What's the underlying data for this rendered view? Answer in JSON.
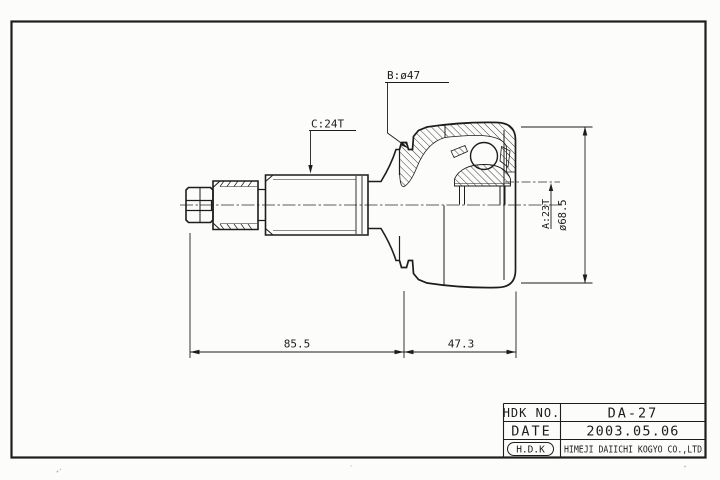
{
  "sheet": {
    "background": "#fcfcfa",
    "line_color": "#1d1d1d"
  },
  "callouts": {
    "b": "B:ø47",
    "c": "C:24T",
    "a": "A:23T",
    "housing_dia": "ø68.5"
  },
  "dimensions": {
    "stem_length": "85.5",
    "housing_length": "47.3"
  },
  "title_block": {
    "part_no_label": "HDK NO.",
    "part_no": "DA-27",
    "date_label": "DATE",
    "date": "2003.05.06",
    "maker_logo": "H.D.K",
    "maker_name": "HIMEJI DAIICHI KOGYO CO.,LTD"
  }
}
